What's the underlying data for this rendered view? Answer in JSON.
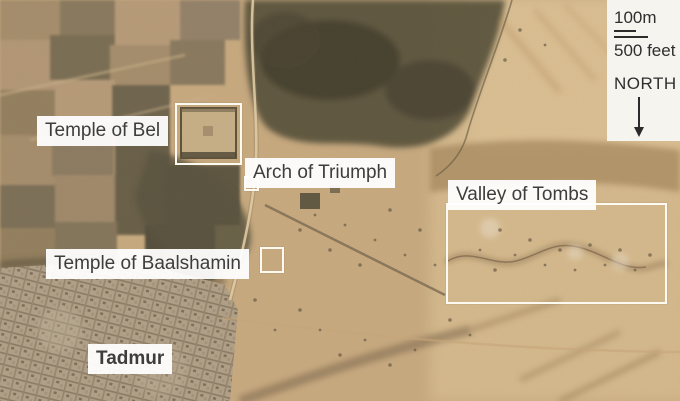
{
  "labels": {
    "temple_of_bel": "Temple of Bel",
    "arch_of_triumph": "Arch of Triumph",
    "temple_of_baalshamin": "Temple of Baalshamin",
    "valley_of_tombs": "Valley of Tombs",
    "city": "Tadmur"
  },
  "scale_panel": {
    "metric_label": "100m",
    "imperial_label": "500 feet",
    "north_label": "NORTH",
    "north_icon": "down-arrow"
  },
  "colors": {
    "label_background": "#ffffff",
    "label_text": "#3d3d3d",
    "highlight_border": "#fdfaf2",
    "panel_background": "#f6f4ef",
    "desert_base": "#c9ab81"
  }
}
